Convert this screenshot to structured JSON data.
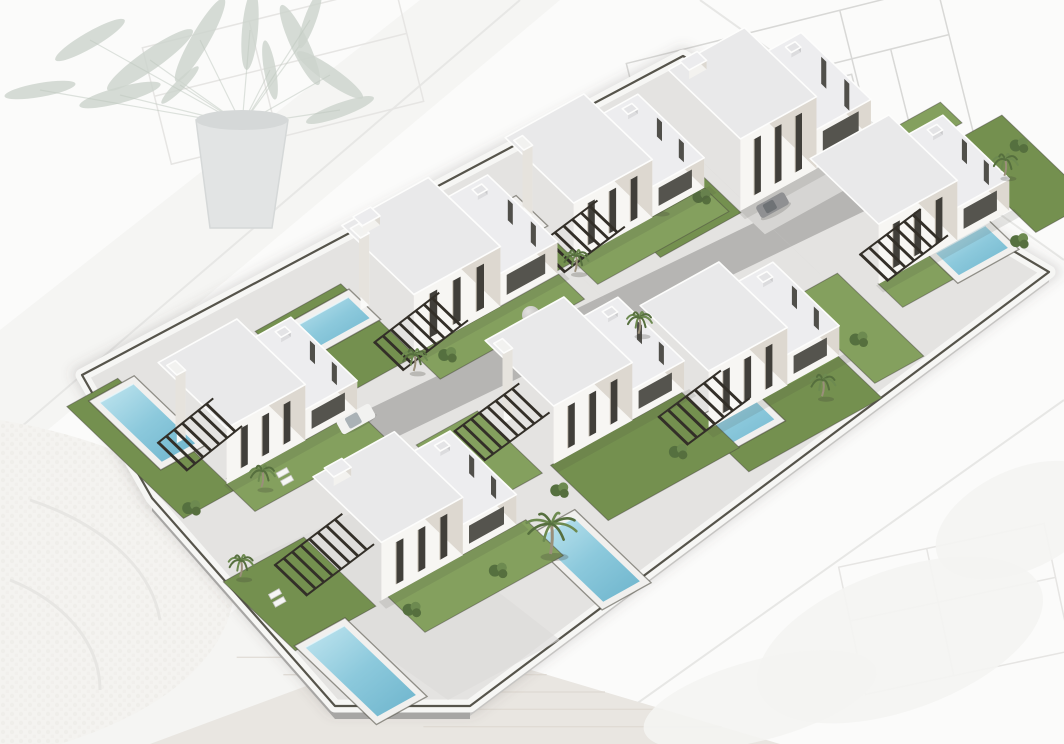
{
  "scene": {
    "kind": "aerial-3d-render",
    "subject": "residential villa development model on architect desk",
    "villa_count": 8
  },
  "palette": {
    "bg": "#fbfbfa",
    "paper": "#f3f3f1",
    "paper_line": "#e7e7e5",
    "blueprint": "#d8d8d6",
    "blueprint_faint": "#e6e5e3",
    "leaf": "#ccd3cc",
    "leaf_dark": "#bfc8bf",
    "pot": "#e2e4e4",
    "pot_shade": "#d5d8d8",
    "sweater": "#f4f3f0",
    "sweater_fold": "#e7e6e3",
    "wood": "#e9e6e1",
    "grain": "#ded9d2",
    "platform": "#e4e3e1",
    "platform_rim": "#f6f6f4",
    "cap_dark": "#454339",
    "side_dark": "#a7a6a4",
    "side_light": "#c6c5c3",
    "road": "#b6b5b3",
    "alley": "#d6d5d3",
    "walk_patch": "#dcdbd9",
    "lawn": "#74904f",
    "lawn_light": "#84a05e",
    "pool_deep": "#6db4cc",
    "pool_mid": "#8cc9dc",
    "pool_light": "#c2e6f0",
    "deck": "#f1f0ee",
    "roof": "#e9e9ea",
    "roof_low": "#ededef",
    "wall_front": "#f7f6f3",
    "wall_side": "#ddd8d0",
    "window_dark": "#413f3a",
    "window_glass": "#55544e",
    "slat": "#332f28",
    "trunk": "#9a8f7a",
    "frond": "#566f3e",
    "frond2": "#6d8a50",
    "bush_dark": "#55703f",
    "white": "#fdfdfc",
    "van_body": "#f2f2f0",
    "van_glass": "#aab2b6",
    "car_body": "#8f9092",
    "car_glass": "#6e7275",
    "sphere": "#cfcecc"
  },
  "axes": {
    "ex": [
      0.875,
      -0.485
    ],
    "ey": [
      0.72,
      0.69
    ]
  },
  "platform": {
    "outline": [
      [
        82,
        375
      ],
      [
        683,
        56
      ],
      [
        1049,
        272
      ],
      [
        470,
        706
      ],
      [
        335,
        706
      ],
      [
        152,
        498
      ]
    ],
    "bottom_edges": [
      [
        [
          152,
          498
        ],
        [
          335,
          706
        ],
        [
          470,
          706
        ]
      ],
      [
        [
          470,
          706
        ],
        [
          1049,
          272
        ]
      ]
    ],
    "extrude_left": 13,
    "extrude_right": 10,
    "walk_patch": [
      [
        250,
        560
      ],
      [
        448,
        700
      ],
      [
        560,
        640
      ],
      [
        380,
        500
      ]
    ]
  },
  "roads": {
    "spine": {
      "x1": 240,
      "y1": 492,
      "x2": 952,
      "y2": 148,
      "half_w": 20
    },
    "alleys": [
      {
        "x1": 527,
        "y1": 225,
        "x2": 671,
        "y2": 363,
        "half_w": 11
      },
      {
        "x1": 688,
        "y1": 148,
        "x2": 818,
        "y2": 272,
        "half_w": 11
      },
      {
        "x1": 842,
        "y1": 112,
        "x2": 948,
        "y2": 214,
        "half_w": 11
      }
    ],
    "sphere": {
      "x": 531,
      "y": 315,
      "r": 9
    }
  },
  "villas": [
    {
      "id": "villa-back-3",
      "cx": 770,
      "cy": 140,
      "W": 150,
      "D": 100,
      "hTall": 72,
      "hLow": 38,
      "tf": 0.58,
      "pillar": false,
      "bulk": true,
      "lawns": [
        [
          -168,
          -52,
          92,
          104
        ],
        [
          60,
          52,
          92,
          30
        ]
      ],
      "drives": [
        [
          -75,
          50,
          132,
          34
        ]
      ],
      "pool": null,
      "perg": [
        -160,
        -32,
        64,
        46,
        7,
        14,
        26
      ],
      "palms": [
        [
          -135,
          8,
          0
        ]
      ],
      "bushes": [
        [
          -120,
          -18
        ],
        [
          -92,
          18
        ]
      ],
      "chairs": []
    },
    {
      "id": "villa-back-2",
      "cx": 605,
      "cy": 192,
      "W": 150,
      "D": 95,
      "hTall": 58,
      "hLow": 30,
      "tf": 0.6,
      "pillar": true,
      "bulk": false,
      "lawns": [
        [
          -168,
          -48,
          95,
          96
        ],
        [
          -75,
          47,
          150,
          34
        ]
      ],
      "drives": [],
      "pool": [
        -132,
        -35,
        58,
        30
      ],
      "perg": [
        -100,
        26,
        70,
        38,
        7,
        12,
        24
      ],
      "palms": [
        [
          -82,
          58,
          0
        ]
      ],
      "bushes": [
        [
          -138,
          22
        ]
      ],
      "chairs": []
    },
    {
      "id": "villa-back-4",
      "cx": 910,
      "cy": 215,
      "W": 150,
      "D": 95,
      "hTall": 60,
      "hLow": 32,
      "tf": 0.6,
      "pillar": false,
      "bulk": false,
      "lawns": [
        [
          78,
          -45,
          64,
          125
        ],
        [
          -75,
          47,
          90,
          34
        ]
      ],
      "drives": [],
      "pool": [
        -10,
        48,
        56,
        32
      ],
      "perg": [
        -76,
        22,
        70,
        38,
        7,
        12,
        24
      ],
      "palms": [
        [
          98,
          12,
          0
        ]
      ],
      "bushes": [
        [
          132,
          -8
        ],
        [
          60,
          80
        ]
      ],
      "chairs": []
    },
    {
      "id": "villa-back-1",
      "cx": 450,
      "cy": 280,
      "W": 165,
      "D": 100,
      "hTall": 60,
      "hLow": 32,
      "tf": 0.6,
      "pillar": true,
      "bulk": true,
      "lawns": [
        [
          -180,
          -52,
          98,
          104
        ],
        [
          -82,
          50,
          165,
          36
        ]
      ],
      "drives": [],
      "pool": [
        -147,
        -36,
        60,
        30
      ],
      "perg": [
        -112,
        30,
        75,
        40,
        8,
        12,
        26
      ],
      "palms": [
        [
          -95,
          65,
          0
        ]
      ],
      "bushes": [
        [
          -152,
          28
        ],
        [
          -58,
          68
        ]
      ],
      "chairs": []
    },
    {
      "id": "villa-front-4",
      "cx": 740,
      "cy": 360,
      "W": 150,
      "D": 95,
      "hTall": 58,
      "hLow": 30,
      "tf": 0.6,
      "pillar": false,
      "bulk": false,
      "lawns": [
        [
          -78,
          45,
          152,
          62
        ],
        [
          80,
          -30,
          56,
          120
        ]
      ],
      "drives": [],
      "pool": [
        -105,
        38,
        85,
        34
      ],
      "perg": [
        -112,
        22,
        72,
        40,
        7,
        12,
        24
      ],
      "palms": [
        [
          32,
          75,
          0
        ]
      ],
      "bushes": [
        [
          102,
          42
        ],
        [
          -62,
          -48
        ]
      ],
      "chairs": []
    },
    {
      "id": "villa-front-3",
      "cx": 585,
      "cy": 395,
      "W": 150,
      "D": 95,
      "hTall": 58,
      "hLow": 30,
      "tf": 0.6,
      "pillar": true,
      "bulk": false,
      "lawns": [
        [
          -78,
          47,
          150,
          80
        ],
        [
          -160,
          -40,
          70,
          90
        ]
      ],
      "drives": [],
      "pool": [
        -143,
        107,
        42,
        92
      ],
      "perg": [
        -132,
        -22,
        75,
        42,
        8,
        12,
        24
      ],
      "palms": [
        [
          85,
          -29,
          0
        ]
      ],
      "bushes": [
        [
          -90,
          75
        ],
        [
          25,
          100
        ]
      ],
      "chairs": [
        [
          -133,
          2
        ]
      ]
    },
    {
      "id": "villa-front-1",
      "cx": 258,
      "cy": 415,
      "W": 150,
      "D": 95,
      "hTall": 56,
      "hLow": 30,
      "tf": 0.6,
      "pillar": true,
      "bulk": false,
      "lawns": [
        [
          -132,
          -105,
          58,
          162
        ],
        [
          -75,
          47,
          150,
          40
        ]
      ],
      "drives": [],
      "pool": [
        -105,
        -92,
        38,
        86
      ],
      "perg": [
        -102,
        -16,
        64,
        40,
        7,
        10,
        24
      ],
      "palms": [
        [
          -52,
          68,
          0
        ]
      ],
      "bushes": [
        [
          -118,
          52
        ]
      ],
      "chairs": [
        [
          -22,
          70
        ]
      ]
    },
    {
      "id": "villa-front-2",
      "cx": 415,
      "cy": 530,
      "W": 155,
      "D": 95,
      "hTall": 58,
      "hLow": 30,
      "tf": 0.6,
      "pillar": false,
      "bulk": true,
      "lawns": [
        [
          -178,
          -50,
          92,
          100
        ],
        [
          -70,
          47,
          158,
          52
        ]
      ],
      "drives": [],
      "pool": [
        -168,
        52,
        44,
        100
      ],
      "perg": [
        -138,
        -28,
        78,
        44,
        8,
        12,
        26
      ],
      "palms": [
        [
          80,
          91,
          1
        ],
        [
          -162,
          -46,
          0
        ]
      ],
      "bushes": [
        [
          -62,
          72
        ],
        [
          30,
          80
        ]
      ],
      "chairs": [
        [
          -146,
          -8
        ]
      ]
    }
  ],
  "vehicles": [
    {
      "name": "white-van",
      "x": 356,
      "y": 419,
      "type": "van"
    },
    {
      "name": "grey-car",
      "x": 773,
      "y": 206,
      "type": "car"
    }
  ],
  "desk": {
    "paper_lines": [
      [
        0,
        445,
        520,
        0
      ],
      [
        580,
        744,
        1064,
        400
      ],
      [
        700,
        0,
        1064,
        260
      ]
    ],
    "papers": [
      [
        [
          0,
          330
        ],
        [
          420,
          0
        ],
        [
          560,
          0
        ],
        [
          0,
          470
        ]
      ],
      [
        [
          60,
          744
        ],
        [
          300,
          560
        ],
        [
          600,
          744
        ]
      ]
    ],
    "blueprints": [
      {
        "rot": -14,
        "ox": 790,
        "oy": 100,
        "color": "blueprint",
        "rects": [
          [
            640,
            25,
            320,
            160
          ],
          [
            660,
            40,
            40,
            26
          ],
          [
            820,
            90,
            36,
            24
          ]
        ],
        "lines": [
          [
            640,
            75,
            960,
            75
          ],
          [
            640,
            130,
            800,
            130
          ],
          [
            760,
            25,
            760,
            185
          ],
          [
            860,
            25,
            860,
            130
          ],
          [
            900,
            75,
            900,
            185
          ]
        ]
      },
      {
        "rot": -14,
        "ox": 300,
        "oy": 60,
        "color": "blueprint_faint",
        "rects": [
          [
            150,
            10,
            260,
            120
          ]
        ],
        "lines": [
          [
            150,
            60,
            410,
            60
          ],
          [
            260,
            10,
            260,
            130
          ]
        ]
      },
      {
        "rot": -12,
        "ox": 950,
        "oy": 610,
        "color": "blueprint_faint",
        "rects": [
          [
            850,
            545,
            210,
            130
          ]
        ],
        "lines": [
          [
            850,
            600,
            1060,
            600
          ],
          [
            940,
            545,
            940,
            675
          ]
        ]
      }
    ],
    "plant": {
      "pot": [
        [
          196,
          120
        ],
        [
          288,
          120
        ],
        [
          272,
          228
        ],
        [
          210,
          228
        ]
      ],
      "leaves": [
        [
          150,
          60,
          52,
          10,
          -35
        ],
        [
          200,
          40,
          48,
          9,
          -60
        ],
        [
          250,
          30,
          40,
          8,
          -85
        ],
        [
          300,
          45,
          44,
          9,
          -115
        ],
        [
          330,
          75,
          40,
          8,
          -145
        ],
        [
          120,
          95,
          42,
          8,
          -15
        ],
        [
          340,
          110,
          36,
          7,
          160
        ],
        [
          270,
          70,
          30,
          6,
          -100
        ],
        [
          180,
          85,
          26,
          5,
          -45
        ],
        [
          90,
          40,
          40,
          8,
          -30
        ],
        [
          40,
          90,
          36,
          7,
          -10
        ],
        [
          310,
          20,
          30,
          6,
          -70
        ]
      ]
    },
    "sweater": {
      "body": "M 0,420 C 120,440 230,490 235,570 C 240,650 170,710 60,744 L 0,744 Z",
      "folds": [
        "M 30,500 C 90,520 150,560 160,620",
        "M 10,580 C 60,600 100,640 100,690"
      ]
    },
    "wood": {
      "poly": [
        [
          150,
          744
        ],
        [
          430,
          640
        ],
        [
          780,
          744
        ]
      ],
      "grain_count": 5
    },
    "blobs": [
      [
        900,
        640,
        150,
        70,
        -20
      ],
      [
        1020,
        520,
        90,
        50,
        -25
      ],
      [
        760,
        700,
        120,
        40,
        -15
      ]
    ]
  }
}
